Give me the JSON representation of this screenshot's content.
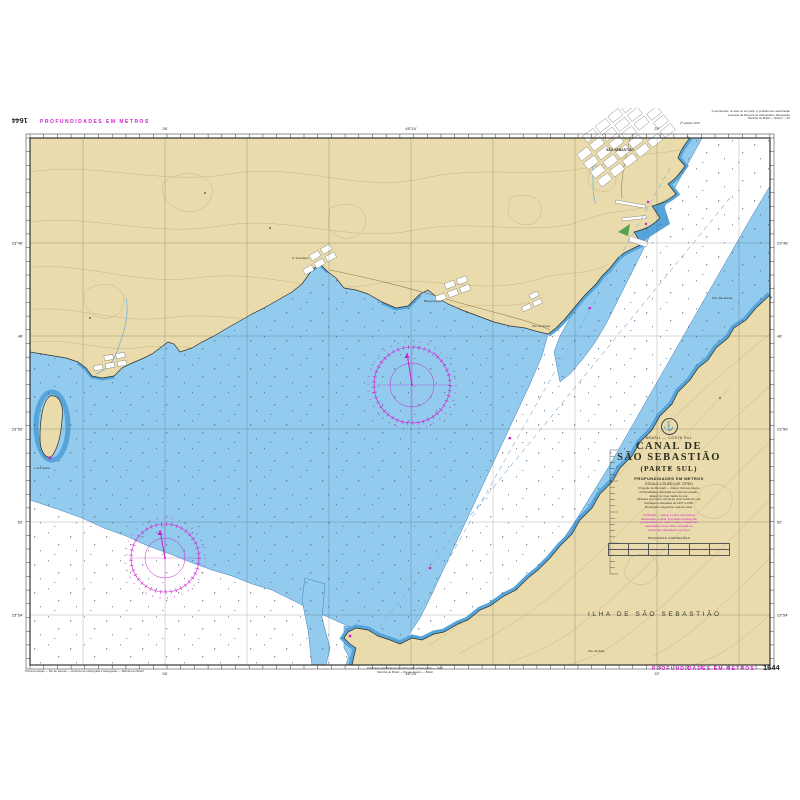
{
  "colors": {
    "magenta": "#cf1fcf",
    "land": "#e9dbab",
    "contour": "#c8b280",
    "shallow": "#92cbee",
    "near": "#55a4da",
    "wline": "#3e7fb5"
  },
  "margins": {
    "chart_number": "1644",
    "depths_note": "PROFUNDIDADES EM METROS",
    "top_right_lines": [
      "A reprodução, no todo ou em parte, é proibida sem autorização",
      "expressa da Diretoria de Hidrografia e Navegação",
      "Marinha do Brasil — Niterói — RJ"
    ],
    "top_right_magenta": "2ª edição 1973",
    "bottom_left_note": "Primeira edição — Rio de Janeiro — Diretoria de Hidrografia e Navegação — Marinha do Brasil",
    "bottom_center_line1": "Publicada pela Diretoria de Hidrografia e Navegação — DHN",
    "bottom_center_line2": "Marinha do Brasil — Rio de Janeiro — Brasil"
  },
  "title_block": {
    "region": "BRASIL — COSTA SUL",
    "title1": "CANAL DE",
    "title2": "SÃO SEBASTIÃO",
    "title3": "(PARTE SUL)",
    "depths": "PROFUNDIDADES EM METROS",
    "scale": "ESCALA 1:25 000 (LAT. 23°50')",
    "info_lines": [
      "Projeção de Mercator — Datum Córrego Alegre",
      "Profundidades reduzidas ao nível de redução,",
      "abaixo do nível médio do mar.",
      "Altitudes em metros acima do nível médio do mar.",
      "Sondagens efetuadas de 1957 a 1960.",
      "Declinação magnética: veja as rosas."
    ],
    "magenta_notes": [
      "CUIDADO — Cabos e dutos submarinos",
      "atravessam o canal. É proibido fundear nas",
      "proximidades dos cabos e dutos submarinos",
      "assinalados nesta carta. Consulte os",
      "Avisos aos Navegantes em vigor."
    ],
    "table_caption": "PEQUENAS CORREÇÕES"
  },
  "map_labels": {
    "island": "ILHA DE SÃO SEBASTIÃO",
    "town": "SÃO SEBASTIÃO",
    "beach1": "S. Francisco",
    "beach2": "Barequeçaba",
    "point1": "Pta. do Araçá",
    "point2": "Pta. das Canas",
    "point3": "Pta. da Sela",
    "islet": "I. dos Gatos"
  },
  "graticule": {
    "top": [
      "26'",
      "45°24'",
      "22'"
    ],
    "bottom": [
      "26'",
      "45°24'",
      "22'"
    ],
    "left": [
      "23°46'",
      "48'",
      "23°50'",
      "52'",
      "23°54'"
    ],
    "right": [
      "23°46'",
      "48'",
      "23°50'",
      "52'",
      "23°54'"
    ]
  }
}
